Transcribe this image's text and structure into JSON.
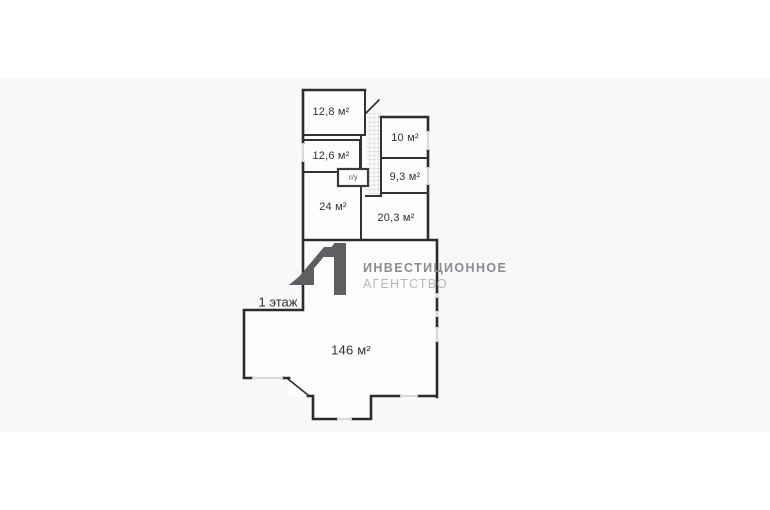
{
  "page": {
    "background_color": "#ffffff",
    "photo_band_color": "#f8f7f9"
  },
  "floor_plan": {
    "floor_label": "1 этаж",
    "wall_color": "#2c2c2e",
    "window_color": "#d8d8da",
    "room_fill_color": "#fdfdfe",
    "stair_hatch_color": "#cdcdd1",
    "rooms": [
      {
        "name": "room-12-8",
        "area_label": "12,8 м²"
      },
      {
        "name": "room-12-6",
        "area_label": "12,6 м²"
      },
      {
        "name": "bathroom",
        "area_label": "с/у"
      },
      {
        "name": "room-24",
        "area_label": "24 м²"
      },
      {
        "name": "room-10",
        "area_label": "10 м²"
      },
      {
        "name": "room-9-3",
        "area_label": "9,3 м²"
      },
      {
        "name": "room-20-3",
        "area_label": "20,3 м²"
      },
      {
        "name": "hall-146",
        "area_label": "146 м²"
      }
    ]
  },
  "watermark": {
    "agency_name_line1": "ИНВЕСТИЦИОННОЕ",
    "agency_name_line2": "АГЕНТСТВО",
    "logo_mark_color": "#5f5f63",
    "line1_color": "#8b8b90",
    "line2_color": "#b9b8bc"
  }
}
